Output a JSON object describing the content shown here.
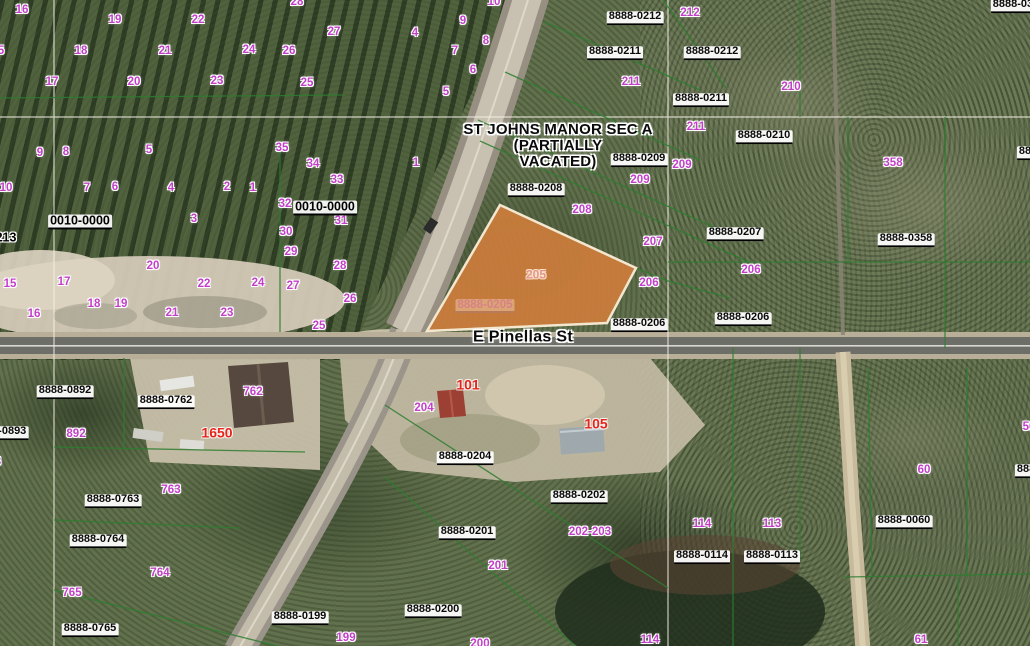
{
  "map": {
    "title_overlay": {
      "line1": "ST JOHNS MANOR SEC A",
      "line2": "(PARTIALLY",
      "line3": "VACATED)"
    },
    "street": {
      "name": "E Pinellas St"
    },
    "highlighted_parcel": {
      "parcel_id": "8888-0205",
      "lot_number": "205",
      "fill_color": "#cd7d3c",
      "border_color": "#f3e7cf"
    },
    "colors": {
      "lot_number_label": "#c33fca",
      "parcel_id_label": "#0a0a0a",
      "address_label": "#e8231a",
      "parcel_line": "#2e7d30",
      "survey_line": "#f2f0e4",
      "road_asphalt": "#6e6e68",
      "dirt_road": "#c7b99c"
    },
    "parcel_id_labels": [
      {
        "t": "8888-0212",
        "x": 635,
        "y": 18
      },
      {
        "t": "8888-0211",
        "x": 615,
        "y": 53
      },
      {
        "t": "8888-0212",
        "x": 712,
        "y": 53
      },
      {
        "t": "8888-0211",
        "x": 701,
        "y": 100
      },
      {
        "t": "8888-0210",
        "x": 764,
        "y": 137
      },
      {
        "t": "8888-0209",
        "x": 639,
        "y": 160
      },
      {
        "t": "8888-0208",
        "x": 536,
        "y": 190
      },
      {
        "t": "8888-0207",
        "x": 735,
        "y": 234
      },
      {
        "t": "8888-0358",
        "x": 906,
        "y": 240
      },
      {
        "t": "8888-0206",
        "x": 639,
        "y": 325
      },
      {
        "t": "8888-0206",
        "x": 743,
        "y": 319
      },
      {
        "t": "8888-035",
        "x": 1016,
        "y": 6
      },
      {
        "t": "8888-0",
        "x": 1036,
        "y": 153
      },
      {
        "t": "8888-0893",
        "x": 0,
        "y": 433
      },
      {
        "t": "8888-0892",
        "x": 65,
        "y": 392
      },
      {
        "t": "8888-0762",
        "x": 166,
        "y": 402
      },
      {
        "t": "8888-0763",
        "x": 113,
        "y": 501
      },
      {
        "t": "8888-0764",
        "x": 98,
        "y": 541
      },
      {
        "t": "8888-0765",
        "x": 90,
        "y": 630
      },
      {
        "t": "8888-0204",
        "x": 465,
        "y": 458
      },
      {
        "t": "8888-0202",
        "x": 579,
        "y": 497
      },
      {
        "t": "8888-0201",
        "x": 467,
        "y": 533
      },
      {
        "t": "8888-0200",
        "x": 433,
        "y": 611
      },
      {
        "t": "8888-0199",
        "x": 300,
        "y": 618
      },
      {
        "t": "8888-0114",
        "x": 702,
        "y": 557
      },
      {
        "t": "8888-0113",
        "x": 772,
        "y": 557
      },
      {
        "t": "8888-0060",
        "x": 904,
        "y": 522
      },
      {
        "t": "8888-0",
        "x": 1034,
        "y": 471
      }
    ],
    "lot_number_labels": [
      {
        "t": "16",
        "x": 22,
        "y": 10
      },
      {
        "t": "19",
        "x": 115,
        "y": 20
      },
      {
        "t": "22",
        "x": 198,
        "y": 20
      },
      {
        "t": "28",
        "x": 297,
        "y": 2
      },
      {
        "t": "27",
        "x": 334,
        "y": 32
      },
      {
        "t": "5",
        "x": 1,
        "y": 51
      },
      {
        "t": "18",
        "x": 81,
        "y": 51
      },
      {
        "t": "21",
        "x": 165,
        "y": 51
      },
      {
        "t": "24",
        "x": 249,
        "y": 50
      },
      {
        "t": "26",
        "x": 289,
        "y": 51
      },
      {
        "t": "17",
        "x": 52,
        "y": 82
      },
      {
        "t": "20",
        "x": 134,
        "y": 82
      },
      {
        "t": "23",
        "x": 217,
        "y": 81
      },
      {
        "t": "25",
        "x": 307,
        "y": 83
      },
      {
        "t": "4",
        "x": 415,
        "y": 33
      },
      {
        "t": "9",
        "x": 463,
        "y": 21
      },
      {
        "t": "10",
        "x": 494,
        "y": 2
      },
      {
        "t": "8",
        "x": 486,
        "y": 41
      },
      {
        "t": "7",
        "x": 455,
        "y": 51
      },
      {
        "t": "6",
        "x": 473,
        "y": 70
      },
      {
        "t": "5",
        "x": 446,
        "y": 92
      },
      {
        "t": "1",
        "x": 416,
        "y": 163
      },
      {
        "t": "212",
        "x": 690,
        "y": 13
      },
      {
        "t": "211",
        "x": 631,
        "y": 82
      },
      {
        "t": "210",
        "x": 791,
        "y": 87
      },
      {
        "t": "211",
        "x": 696,
        "y": 127
      },
      {
        "t": "209",
        "x": 682,
        "y": 165
      },
      {
        "t": "209",
        "x": 640,
        "y": 180
      },
      {
        "t": "208",
        "x": 582,
        "y": 210
      },
      {
        "t": "207",
        "x": 653,
        "y": 242
      },
      {
        "t": "206",
        "x": 649,
        "y": 283
      },
      {
        "t": "206",
        "x": 751,
        "y": 270
      },
      {
        "t": "358",
        "x": 893,
        "y": 163
      },
      {
        "t": "9",
        "x": 40,
        "y": 153
      },
      {
        "t": "8",
        "x": 66,
        "y": 152
      },
      {
        "t": "5",
        "x": 149,
        "y": 150
      },
      {
        "t": "35",
        "x": 282,
        "y": 148
      },
      {
        "t": "34",
        "x": 313,
        "y": 164
      },
      {
        "t": "33",
        "x": 337,
        "y": 180
      },
      {
        "t": "10",
        "x": 6,
        "y": 188
      },
      {
        "t": "7",
        "x": 87,
        "y": 188
      },
      {
        "t": "6",
        "x": 115,
        "y": 187
      },
      {
        "t": "4",
        "x": 171,
        "y": 188
      },
      {
        "t": "2",
        "x": 227,
        "y": 187
      },
      {
        "t": "1",
        "x": 253,
        "y": 188
      },
      {
        "t": "32",
        "x": 285,
        "y": 204
      },
      {
        "t": "31",
        "x": 341,
        "y": 221
      },
      {
        "t": "3",
        "x": 194,
        "y": 219
      },
      {
        "t": "30",
        "x": 286,
        "y": 232
      },
      {
        "t": "29",
        "x": 291,
        "y": 252
      },
      {
        "t": "28",
        "x": 340,
        "y": 266
      },
      {
        "t": "20",
        "x": 153,
        "y": 266
      },
      {
        "t": "15",
        "x": 10,
        "y": 284
      },
      {
        "t": "17",
        "x": 64,
        "y": 282
      },
      {
        "t": "22",
        "x": 204,
        "y": 284
      },
      {
        "t": "24",
        "x": 258,
        "y": 283
      },
      {
        "t": "27",
        "x": 293,
        "y": 286
      },
      {
        "t": "26",
        "x": 350,
        "y": 299
      },
      {
        "t": "18",
        "x": 94,
        "y": 304
      },
      {
        "t": "19",
        "x": 121,
        "y": 304
      },
      {
        "t": "16",
        "x": 34,
        "y": 314
      },
      {
        "t": "21",
        "x": 172,
        "y": 313
      },
      {
        "t": "23",
        "x": 227,
        "y": 313
      },
      {
        "t": "25",
        "x": 319,
        "y": 326
      },
      {
        "t": "762",
        "x": 253,
        "y": 392
      },
      {
        "t": "892",
        "x": 76,
        "y": 434
      },
      {
        "t": "3",
        "x": -2,
        "y": 462
      },
      {
        "t": "763",
        "x": 171,
        "y": 490
      },
      {
        "t": "764",
        "x": 160,
        "y": 573
      },
      {
        "t": "765",
        "x": 72,
        "y": 593
      },
      {
        "t": "204",
        "x": 424,
        "y": 408
      },
      {
        "t": "202-203",
        "x": 590,
        "y": 532
      },
      {
        "t": "201",
        "x": 498,
        "y": 566
      },
      {
        "t": "200",
        "x": 480,
        "y": 644
      },
      {
        "t": "199",
        "x": 346,
        "y": 638
      },
      {
        "t": "114",
        "x": 702,
        "y": 524
      },
      {
        "t": "113",
        "x": 772,
        "y": 524
      },
      {
        "t": "60",
        "x": 924,
        "y": 470
      },
      {
        "t": "56",
        "x": 1029,
        "y": 427
      },
      {
        "t": "114",
        "x": 650,
        "y": 640
      },
      {
        "t": "61",
        "x": 921,
        "y": 640
      }
    ],
    "address_labels": [
      {
        "t": "101",
        "x": 468,
        "y": 385
      },
      {
        "t": "105",
        "x": 596,
        "y": 424
      },
      {
        "t": "1650",
        "x": 217,
        "y": 433
      }
    ],
    "plat_labels": [
      {
        "t": "0010-0000",
        "x": 80,
        "y": 222,
        "u": true
      },
      {
        "t": "0010-0000",
        "x": 325,
        "y": 208,
        "u": true
      },
      {
        "t": "213",
        "x": 6,
        "y": 238,
        "u": false
      }
    ]
  }
}
